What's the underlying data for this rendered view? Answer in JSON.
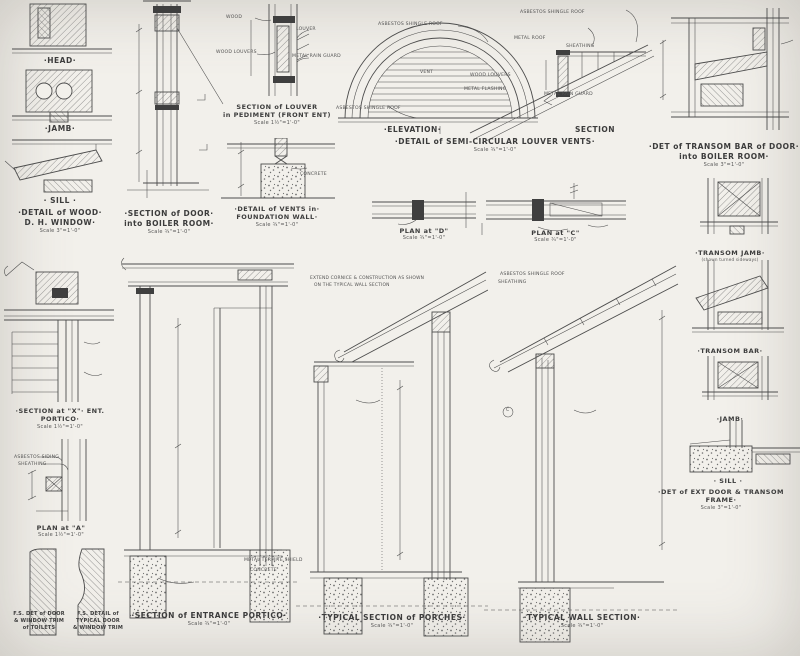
{
  "sheet": {
    "bg": "#f2f0eb",
    "ink": "#4c4c4c"
  },
  "panels": {
    "dh_window": {
      "head": "·HEAD·",
      "jamb": "·JAMB·",
      "sill": "· SILL ·",
      "title1": "·DETAIL of WOOD·",
      "title2": "D. H. WINDOW·",
      "scale": "Scale 3\"=1'-0\""
    },
    "door_boiler": {
      "title1": "·SECTION of DOOR·",
      "title2": "into BOILER ROOM·",
      "scale": "Scale ¾\"=1'-0\""
    },
    "louver_pediment": {
      "title1": "SECTION of LOUVER",
      "title2": "in PEDIMENT (FRONT ENT)",
      "scale": "Scale 1½\"=1'-0\"",
      "labels": {
        "wood": "WOOD",
        "louver": "LOUVER",
        "wood_louvers": "WOOD LOUVERS",
        "rain_guard": "METAL RAIN GUARD"
      }
    },
    "vents_foundation": {
      "title1": "·DETAIL of VENTS in·",
      "title2": "FOUNDATION WALL·",
      "scale": "Scale ¾\"=1'-0\"",
      "labels": {
        "concrete": "CONCRETE"
      }
    },
    "semi_louver": {
      "elevation": "·ELEVATION·",
      "section": "SECTION",
      "title": "·DETAIL of SEMI-CIRCULAR LOUVER VENTS·",
      "scale": "Scale ¾\"=1'-0\"",
      "labels": {
        "shingle_top": "ASBESTOS SHINGLE ROOF",
        "shingle_bottom": "ASBESTOS SHINGLE ROOF",
        "shingle_right": "ASBESTOS SHINGLE ROOF",
        "vent": "VENT",
        "metal_roof": "METAL ROOF",
        "sheathing": "SHEATHING",
        "wood_louvers": "WOOD LOUVERS",
        "metal_flashing": "METAL FLASHING",
        "rain_guard": "METAL RAIN GUARD"
      }
    },
    "transom_bar_boiler": {
      "title1": "·DET of TRANSOM BAR of DOOR·",
      "title2": "into BOILER ROOM·",
      "scale": "Scale 3\"=1'-0\""
    },
    "door_frame_stack": {
      "transom_jamb": "·TRANSOM JAMB·",
      "transom_jamb_sub": "(shown turned sideways)",
      "transom_bar": "·TRANSOM BAR·",
      "jamb": "·JAMB·",
      "sill": "· SILL ·",
      "title": "·DET of EXT DOOR & TRANSOM FRAME·",
      "scale": "Scale 3\"=1'-0\""
    },
    "plan_d": {
      "title": "PLAN at \"D\"",
      "scale": "Scale ¾\"=1'-0\""
    },
    "plan_c": {
      "title": "PLAN at \"C\"",
      "scale": "Scale ¾\"=1'-0\""
    },
    "section_x": {
      "title": "·SECTION at \"X\"· ENT. PORTICO·",
      "scale": "Scale 1½\"=1'-0\""
    },
    "plan_a": {
      "title": "PLAN at \"A\"",
      "scale": "Scale 1½\"=1'-0\"",
      "labels": {
        "siding": "ASBESTOS SIDING",
        "sheathing": "SHEATHING"
      }
    },
    "moldings": {
      "left1": "F.S. DET of DOOR",
      "left2": "& WINDOW TRIM",
      "left3": "of TOILETS",
      "right1": "F.S. DETAIL of",
      "right2": "TYPICAL DOOR",
      "right3": "& WINDOW TRIM"
    },
    "entrance_portico": {
      "title": "·SECTION of ENTRANCE PORTICO·",
      "scale": "Scale ¾\"=1'-0\"",
      "labels": {
        "termite": "METAL TERMITE SHIELD",
        "concrete": "CONCRETE"
      }
    },
    "porches": {
      "title": "·TYPICAL SECTION of PORCHES·",
      "scale": "Scale ¾\"=1'-0\"",
      "note1": "EXTEND CORNICE & CONSTRUCTION AS SHOWN",
      "note2": "ON THE TYPICAL WALL SECTION"
    },
    "wall_section": {
      "title": "·TYPICAL WALL SECTION·",
      "scale": "Scale ¾\"=1'-0\"",
      "labels": {
        "shingle": "ASBESTOS SHINGLE ROOF",
        "sheathing": "SHEATHING",
        "marker_c": "C"
      }
    }
  }
}
